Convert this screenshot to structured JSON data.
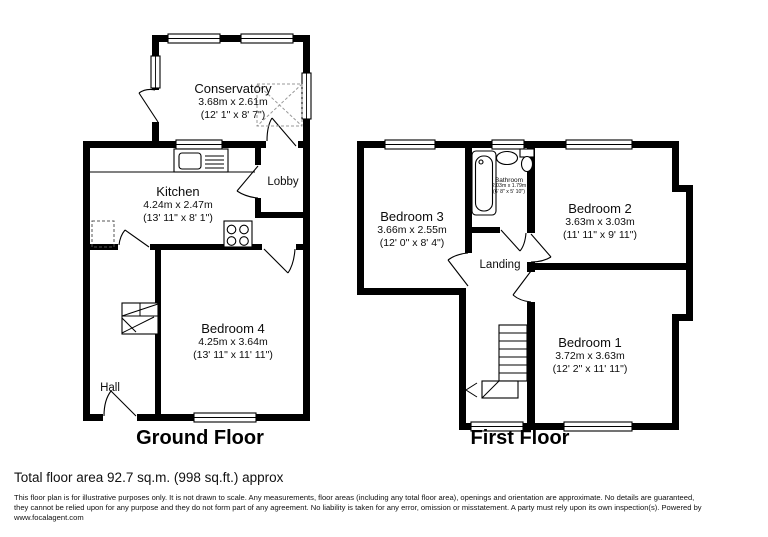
{
  "floors": {
    "ground": {
      "title": "Ground Floor",
      "rooms": {
        "conservatory": {
          "name": "Conservatory",
          "metric": "3.68m x 2.61m",
          "imperial": "(12' 1\" x 8' 7\")"
        },
        "kitchen": {
          "name": "Kitchen",
          "metric": "4.24m x 2.47m",
          "imperial": "(13' 11\" x 8' 1\")"
        },
        "lobby": {
          "name": "Lobby"
        },
        "hall": {
          "name": "Hall"
        },
        "bedroom4": {
          "name": "Bedroom 4",
          "metric": "4.25m x 3.64m",
          "imperial": "(13' 11\" x 11' 11\")"
        }
      }
    },
    "first": {
      "title": "First Floor",
      "rooms": {
        "bedroom3": {
          "name": "Bedroom 3",
          "metric": "3.66m x 2.55m",
          "imperial": "(12' 0\" x 8' 4\")"
        },
        "bathroom": {
          "name": "Bathroom",
          "metric": "2.03m x 1.79m",
          "imperial": "(6' 8\" x 5' 10\")"
        },
        "bedroom2": {
          "name": "Bedroom 2",
          "metric": "3.63m x 3.03m",
          "imperial": "(11' 11\" x 9' 11\")"
        },
        "landing": {
          "name": "Landing"
        },
        "bedroom1": {
          "name": "Bedroom 1",
          "metric": "3.72m x 3.63m",
          "imperial": "(12' 2\" x 11' 11\")"
        }
      }
    }
  },
  "footer": {
    "total_area": "Total floor area 92.7 sq.m. (998 sq.ft.) approx",
    "disclaimer_lines": [
      "This floor plan is for illustrative purposes only. It is not drawn to scale. Any measurements, floor areas (including any total floor area), openings and orientation are approximate. No details are guaranteed,",
      "they cannot be relied upon for any purpose and they do not form part of any agreement. No liability is taken for any error, omission or misstatement. A party must rely upon its own inspection(s). Powered by",
      "www.focalagent.com"
    ]
  },
  "fixtures": [
    "bathtub",
    "toilet",
    "wash-basin",
    "kitchen-sink",
    "hob",
    "stairs",
    "roof-light",
    "appliance-space"
  ],
  "colors": {
    "wall": "#000000",
    "background": "#ffffff",
    "text": "#111111"
  }
}
